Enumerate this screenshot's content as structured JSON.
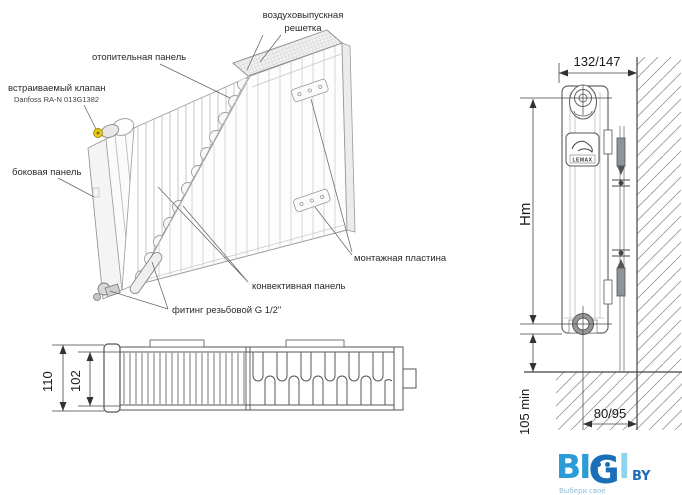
{
  "main_diagram": {
    "labels": {
      "air_grille": {
        "line1": "воздуховыпускная",
        "line2": "решетка"
      },
      "heating_panel": "отопительная панель",
      "built_in_valve": {
        "line1": "встраиваемый клапан",
        "line2": "Danfoss RA-N 013G1382"
      },
      "side_panel": "боковая панель",
      "mounting_plate": "монтажная пластина",
      "convective_panel": "конвективная панель",
      "threaded_fitting": "фитинг резьбовой G 1/2\""
    }
  },
  "section_view": {
    "dim_overall_depth": "110",
    "dim_panel_depth": "102"
  },
  "side_view": {
    "dim_top": "132/147",
    "dim_height": "Hm",
    "dim_floor_clearance": "105 min",
    "dim_wall_offset": "80/95",
    "brand_badge": "LEMAX"
  },
  "logo": {
    "text_bi": "BI",
    "letter_g": "G",
    "letter_l": "l",
    "suffix": "BY",
    "tagline": "Выбери своё"
  },
  "colors": {
    "logo_primary": "#2b9cd8",
    "logo_dark": "#1a6fb8",
    "logo_light": "#8ed3ee",
    "valve_accent": "#e8c71c"
  }
}
